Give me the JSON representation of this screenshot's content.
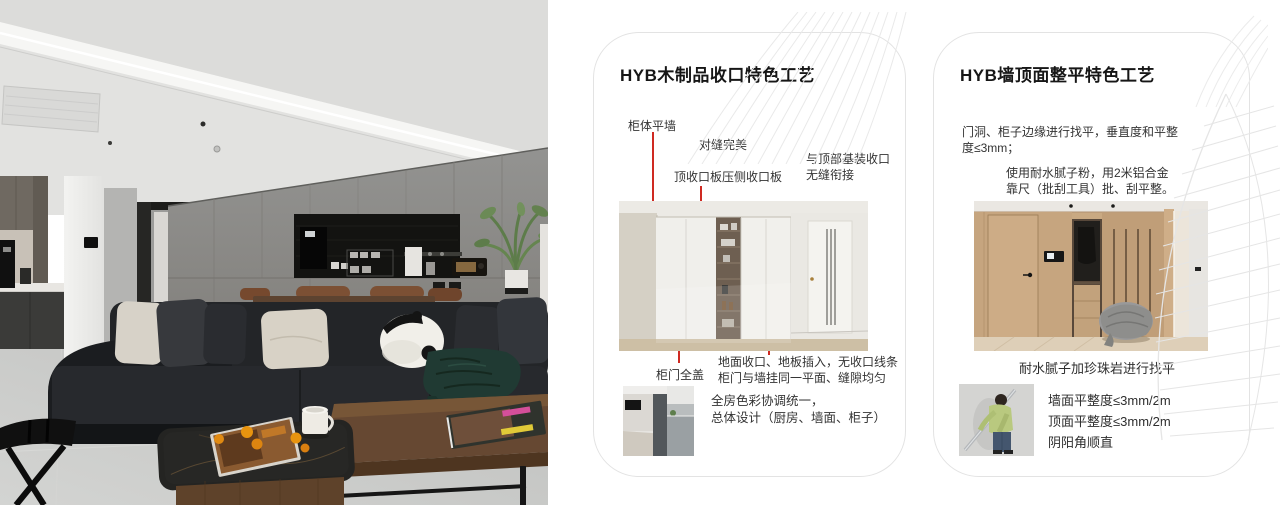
{
  "cards": [
    {
      "title": "HYB木制品收口特色工艺",
      "labels": {
        "cabinet_flat_wall": "柜体平墙",
        "seam_perfect": "对缝完美",
        "top_board": "顶收口板压侧收口板",
        "top_joint_line1": "与顶部基装收口",
        "top_joint_line2": "无缝衔接",
        "door_full_cover": "柜门全盖",
        "floor_joint_line1": "地面收口、地板插入，无收口线条",
        "floor_joint_line2": "柜门与墙挂同一平面、缝隙均匀"
      },
      "summary_line1": "全房色彩协调统一，",
      "summary_line2": "总体设计（厨房、墙面、柜子）"
    },
    {
      "title": "HYB墙顶面整平特色工艺",
      "para1_line1": "门洞、柜子边缘进行找平，垂直度和平整",
      "para1_line2": "度≤3mm；",
      "para2_line1": "使用耐水腻子粉，用2米铝合金",
      "para2_line2": "靠尺（批刮工具）批、刮平整。",
      "caption": "耐水腻子加珍珠岩进行找平",
      "specs": [
        "墙面平整度≤3mm/2m",
        "顶面平整度≤3mm/2m",
        "阴阳角顺直"
      ]
    }
  ],
  "colors": {
    "annotation_line": "#cf2a22",
    "card_border": "#e3e3e3",
    "title_text": "#161616",
    "body_text": "#333333",
    "decor_line": "#e8e8e8"
  }
}
